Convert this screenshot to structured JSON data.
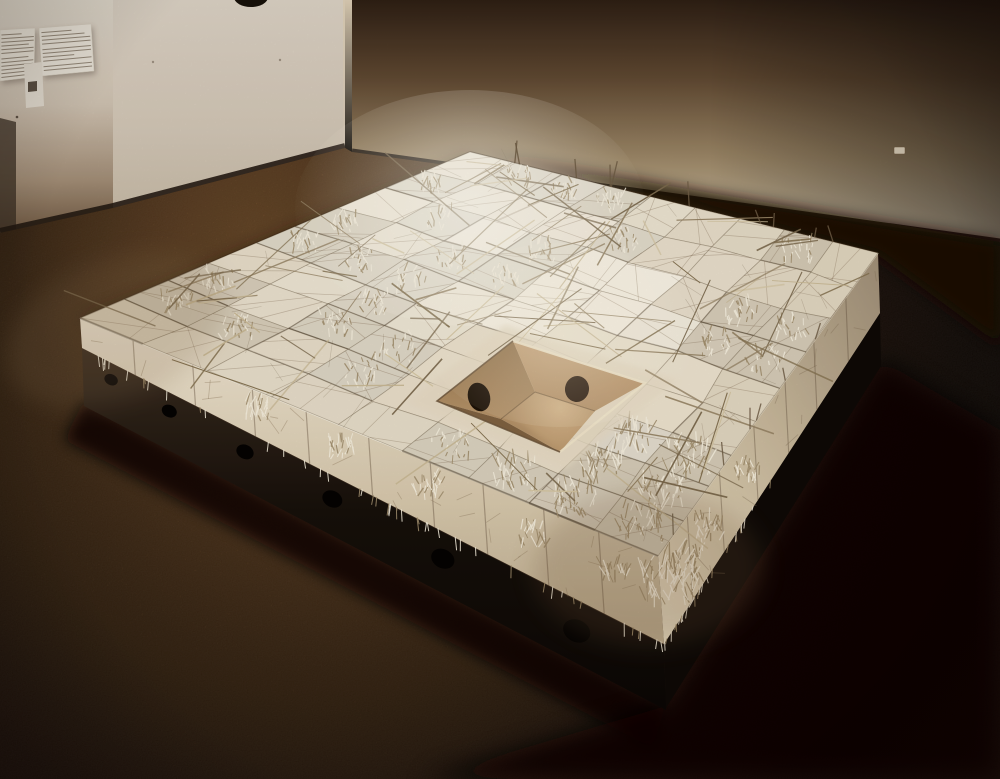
{
  "scene": {
    "alt_text": "Gallery installation photograph: a large square platform of white shredded-clay blocks crossed with thin sticks rests on a dark steel base pierced by round holes; a square tan pit with two oval holes is recessed at the center; two small text panels and a leaflet holder hang on the wall at upper left in a dim brown-carpeted room."
  },
  "room": {
    "wall_labels": [
      {
        "name": "exhibition-text-panel-left",
        "text_lines": 12
      },
      {
        "name": "exhibition-text-panel-right",
        "text_lines": 11
      }
    ],
    "leaflet_holder": true,
    "power_outlet": true,
    "pendant_lamp": true
  },
  "platform": {
    "grid": {
      "rows": 9,
      "cols": 9
    },
    "shaggy_ratio": 0.34,
    "sticks": 96,
    "scratches": 42,
    "base_holes": 6,
    "edge_pokers": 16,
    "pit": {
      "interior_holes": 2
    }
  },
  "palette": {
    "wall_light": "#d9d0c2",
    "wall_dark": "#6f5842",
    "right_wall_top": "#2e1f14",
    "right_wall_bottom": "#cfc1a8",
    "floor_lit": "#724c26",
    "floor_dark": "#130a05",
    "block_near": "#f9f3e5",
    "block_far": "#c2b08f",
    "block_side": "#e6dabf",
    "apron": "#e9ddc5",
    "tuft_light": "#f7f0df",
    "tuft_dark": "#a3906f",
    "stick_dark": "#83704f",
    "stick_light": "#c9b893",
    "base_dark": "#120b07",
    "pit_wall_left": "#a07c52",
    "pit_wall_right": "#c4a076",
    "pit_floor": "#cfae83",
    "pit_hole": "#221509",
    "label_paper": "#ebe5d8",
    "label_text": "#8e8170"
  }
}
